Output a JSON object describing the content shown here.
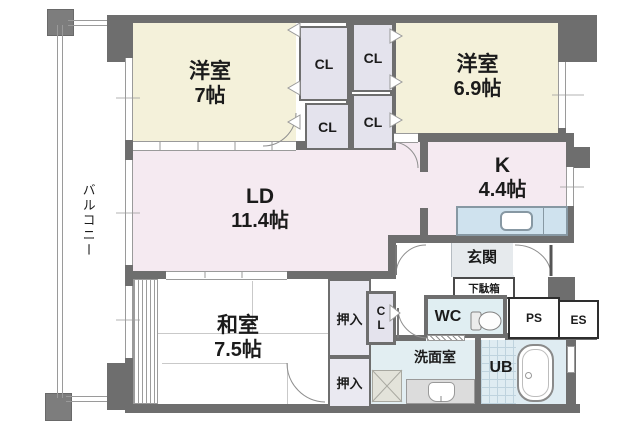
{
  "plan_type": "apartment-floor-plan",
  "rooms": {
    "w7": {
      "name": "洋室",
      "size": "7帖"
    },
    "w69": {
      "name": "洋室",
      "size": "6.9帖"
    },
    "k": {
      "name": "K",
      "size": "4.4帖"
    },
    "ld": {
      "name": "LD",
      "size": "11.4帖"
    },
    "washitsu": {
      "name": "和室",
      "size": "7.5帖"
    },
    "genkan": {
      "name": "玄関"
    },
    "wc": {
      "name": "WC"
    },
    "senmen": {
      "name": "洗面室"
    },
    "ub": {
      "name": "UB"
    },
    "balcony": {
      "name": "バルコニー"
    }
  },
  "storage": {
    "closet": "CL",
    "hall_closet": "CL",
    "futon_closet": "押入",
    "shoe_cabinet": "下駄箱"
  },
  "shafts": {
    "ps": "PS",
    "es": "ES"
  },
  "icons": {
    "toilet": "toilet-icon",
    "bathtub": "bathtub-icon",
    "kitchen_sink": "kitchen-sink-icon",
    "washbasin": "washbasin-icon",
    "washing_machine_pan": "washing-machine-pan-icon",
    "door_swing": "door-swing-arc",
    "folding_door": "folding-door-chevron"
  },
  "colors": {
    "wall": "#6e6e6e",
    "western_room": "#f4f1da",
    "living_dining": "#f5eaf1",
    "kitchen": "#f5eaf1",
    "closet": "#e4e3ed",
    "entrance": "#e6eaed",
    "wet_area": "#e1edf2",
    "kitchen_counter": "#cfe2ee",
    "balcony_rail": "#9a9a9a"
  }
}
